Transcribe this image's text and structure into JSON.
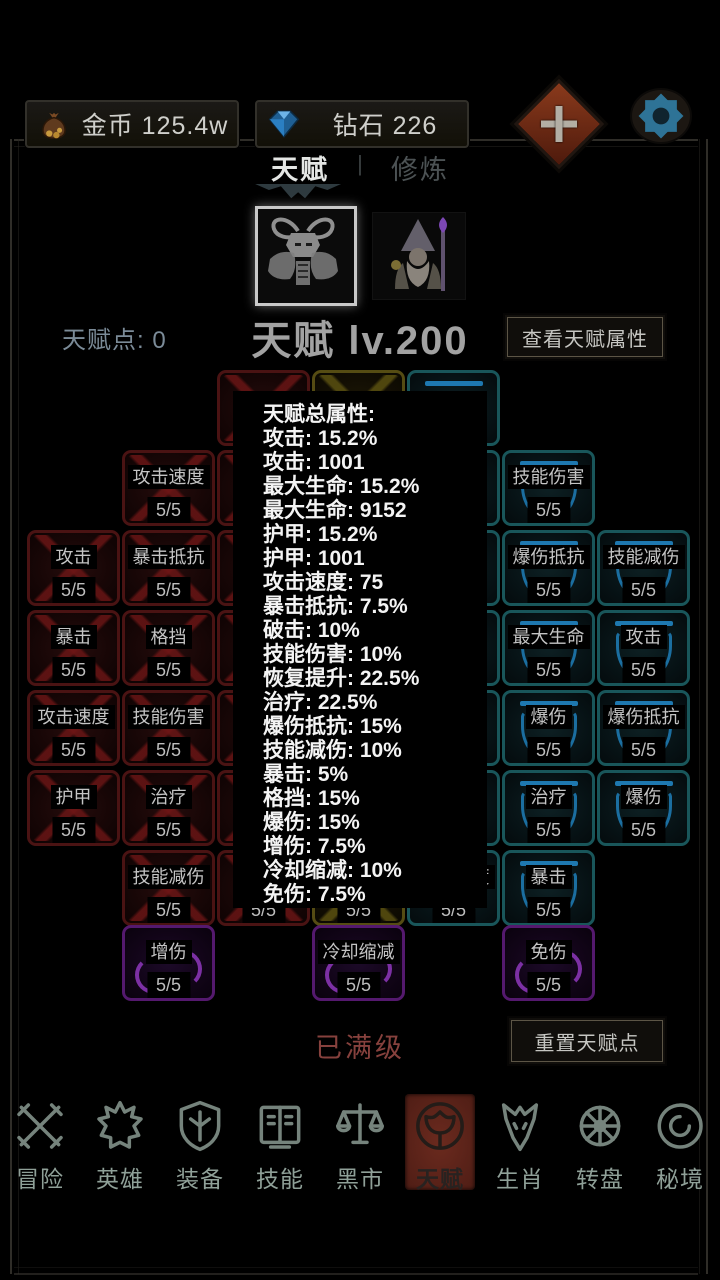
{
  "colors": {
    "tile-red": "#4a1313",
    "tile-yellow": "#554c13",
    "tile-teal": "#19565a",
    "tile-purple": "#54196e",
    "shield-blue": "#1e78b0",
    "crescent-purple": "#7c30a4",
    "nav-active-bg": "#5e241b",
    "gear-blue": "#2e7396",
    "plus-red": "#8a3a1c"
  },
  "topbar": {
    "gold": "金币 125.4w",
    "diamond": "钻石 226",
    "gold_icon": "moneybag-icon",
    "diamond_icon": "diamond-icon",
    "plus_icon": "plus-icon",
    "settings_icon": "gear-icon"
  },
  "tabs": {
    "talent": "天赋",
    "divider": "|",
    "cultivate": "修炼"
  },
  "header": {
    "points": "天赋点: 0",
    "level": "天赋 lv.200",
    "view_attrs": "查看天赋属性"
  },
  "popup": {
    "lines": [
      "天赋总属性:",
      "攻击: 15.2%",
      "攻击: 1001",
      "最大生命: 15.2%",
      "最大生命: 9152",
      "护甲: 15.2%",
      "护甲: 1001",
      "攻击速度: 75",
      "暴击抵抗: 7.5%",
      "破击: 10%",
      "技能伤害: 10%",
      "恢复提升: 22.5%",
      "治疗: 22.5%",
      "爆伤抵抗: 15%",
      "技能减伤: 10%",
      "暴击: 5%",
      "格挡: 15%",
      "爆伤: 15%",
      "增伤: 7.5%",
      "冷却缩减: 10%",
      "免伤: 7.5%"
    ]
  },
  "grid": {
    "tiles": [
      {
        "col": "A",
        "row": 2,
        "label": "攻击",
        "level": "5/5",
        "color": "red"
      },
      {
        "col": "A",
        "row": 3,
        "label": "暴击",
        "level": "5/5",
        "color": "red"
      },
      {
        "col": "A",
        "row": 4,
        "label": "攻击速度",
        "level": "5/5",
        "color": "red"
      },
      {
        "col": "A",
        "row": 5,
        "label": "护甲",
        "level": "5/5",
        "color": "red"
      },
      {
        "col": "B",
        "row": 1,
        "label": "攻击速度",
        "level": "5/5",
        "color": "red"
      },
      {
        "col": "B",
        "row": 2,
        "label": "暴击抵抗",
        "level": "5/5",
        "color": "red"
      },
      {
        "col": "B",
        "row": 3,
        "label": "格挡",
        "level": "5/5",
        "color": "red"
      },
      {
        "col": "B",
        "row": 4,
        "label": "技能伤害",
        "level": "5/5",
        "color": "red"
      },
      {
        "col": "B",
        "row": 5,
        "label": "治疗",
        "level": "5/5",
        "color": "red"
      },
      {
        "col": "B",
        "row": 6,
        "label": "技能减伤",
        "level": "5/5",
        "color": "red"
      },
      {
        "col": "B",
        "row": 7,
        "label": "增伤",
        "level": "5/5",
        "color": "purple"
      },
      {
        "col": "C",
        "row": 0,
        "label": "",
        "level": "5/5",
        "color": "red"
      },
      {
        "col": "C",
        "row": 1,
        "label": "",
        "level": "5/5",
        "color": "red"
      },
      {
        "col": "C",
        "row": 2,
        "label": "",
        "level": "5/5",
        "color": "red"
      },
      {
        "col": "C",
        "row": 3,
        "label": "",
        "level": "5/5",
        "color": "red"
      },
      {
        "col": "C",
        "row": 4,
        "label": "",
        "level": "5/5",
        "color": "red"
      },
      {
        "col": "C",
        "row": 5,
        "label": "",
        "level": "5/5",
        "color": "red"
      },
      {
        "col": "C",
        "row": 6,
        "label": "",
        "level": "5/5",
        "color": "red"
      },
      {
        "col": "D",
        "row": 0,
        "label": "",
        "level": "5/5",
        "color": "yellow"
      },
      {
        "col": "D",
        "row": 1,
        "label": "",
        "level": "5/5",
        "color": "yellow"
      },
      {
        "col": "D",
        "row": 2,
        "label": "",
        "level": "5/5",
        "color": "yellow"
      },
      {
        "col": "D",
        "row": 3,
        "label": "",
        "level": "5/5",
        "color": "yellow"
      },
      {
        "col": "D",
        "row": 4,
        "label": "",
        "level": "5/5",
        "color": "yellow"
      },
      {
        "col": "D",
        "row": 5,
        "label": "",
        "level": "5/5",
        "color": "yellow"
      },
      {
        "col": "D",
        "row": 6,
        "label": "",
        "level": "5/5",
        "color": "yellow"
      },
      {
        "col": "D",
        "row": 7,
        "label": "冷却缩减",
        "level": "5/5",
        "color": "purple"
      },
      {
        "col": "E",
        "row": 0,
        "label": "",
        "level": "5/5",
        "color": "teal"
      },
      {
        "col": "E",
        "row": 1,
        "label": "",
        "level": "5/5",
        "color": "teal"
      },
      {
        "col": "E",
        "row": 2,
        "label": "",
        "level": "5/5",
        "color": "teal"
      },
      {
        "col": "E",
        "row": 3,
        "label": "",
        "level": "5/5",
        "color": "teal"
      },
      {
        "col": "E",
        "row": 4,
        "label": "",
        "level": "5/5",
        "color": "teal"
      },
      {
        "col": "E",
        "row": 5,
        "label": "",
        "level": "5/5",
        "color": "teal"
      },
      {
        "col": "E",
        "row": 6,
        "label": "攻击速度",
        "level": "5/5",
        "color": "teal"
      },
      {
        "col": "F",
        "row": 1,
        "label": "技能伤害",
        "level": "5/5",
        "color": "teal"
      },
      {
        "col": "F",
        "row": 2,
        "label": "爆伤抵抗",
        "level": "5/5",
        "color": "teal"
      },
      {
        "col": "F",
        "row": 3,
        "label": "最大生命",
        "level": "5/5",
        "color": "teal"
      },
      {
        "col": "F",
        "row": 4,
        "label": "爆伤",
        "level": "5/5",
        "color": "teal"
      },
      {
        "col": "F",
        "row": 5,
        "label": "治疗",
        "level": "5/5",
        "color": "teal"
      },
      {
        "col": "F",
        "row": 6,
        "label": "暴击",
        "level": "5/5",
        "color": "teal"
      },
      {
        "col": "F",
        "row": 7,
        "label": "免伤",
        "level": "5/5",
        "color": "purple"
      },
      {
        "col": "G",
        "row": 2,
        "label": "技能减伤",
        "level": "5/5",
        "color": "teal"
      },
      {
        "col": "G",
        "row": 3,
        "label": "攻击",
        "level": "5/5",
        "color": "teal"
      },
      {
        "col": "G",
        "row": 4,
        "label": "爆伤抵抗",
        "level": "5/5",
        "color": "teal"
      },
      {
        "col": "G",
        "row": 5,
        "label": "爆伤",
        "level": "5/5",
        "color": "teal"
      }
    ]
  },
  "footer": {
    "maxed": "已满级",
    "reset": "重置天赋点"
  },
  "nav": {
    "items": [
      {
        "id": "adventure",
        "label": "冒险",
        "icon": "crossed-swords-icon",
        "active": false
      },
      {
        "id": "hero",
        "label": "英雄",
        "icon": "hero-helmet-icon",
        "active": false
      },
      {
        "id": "equipment",
        "label": "装备",
        "icon": "shield-icon",
        "active": false
      },
      {
        "id": "skills",
        "label": "技能",
        "icon": "spellbook-icon",
        "active": false
      },
      {
        "id": "market",
        "label": "黑市",
        "icon": "scales-icon",
        "active": false
      },
      {
        "id": "talent",
        "label": "天赋",
        "icon": "talent-tree-icon",
        "active": true
      },
      {
        "id": "zodiac",
        "label": "生肖",
        "icon": "wolf-icon",
        "active": false
      },
      {
        "id": "wheel",
        "label": "转盘",
        "icon": "spin-wheel-icon",
        "active": false
      },
      {
        "id": "realm",
        "label": "秘境",
        "icon": "vortex-icon",
        "active": false
      }
    ]
  }
}
